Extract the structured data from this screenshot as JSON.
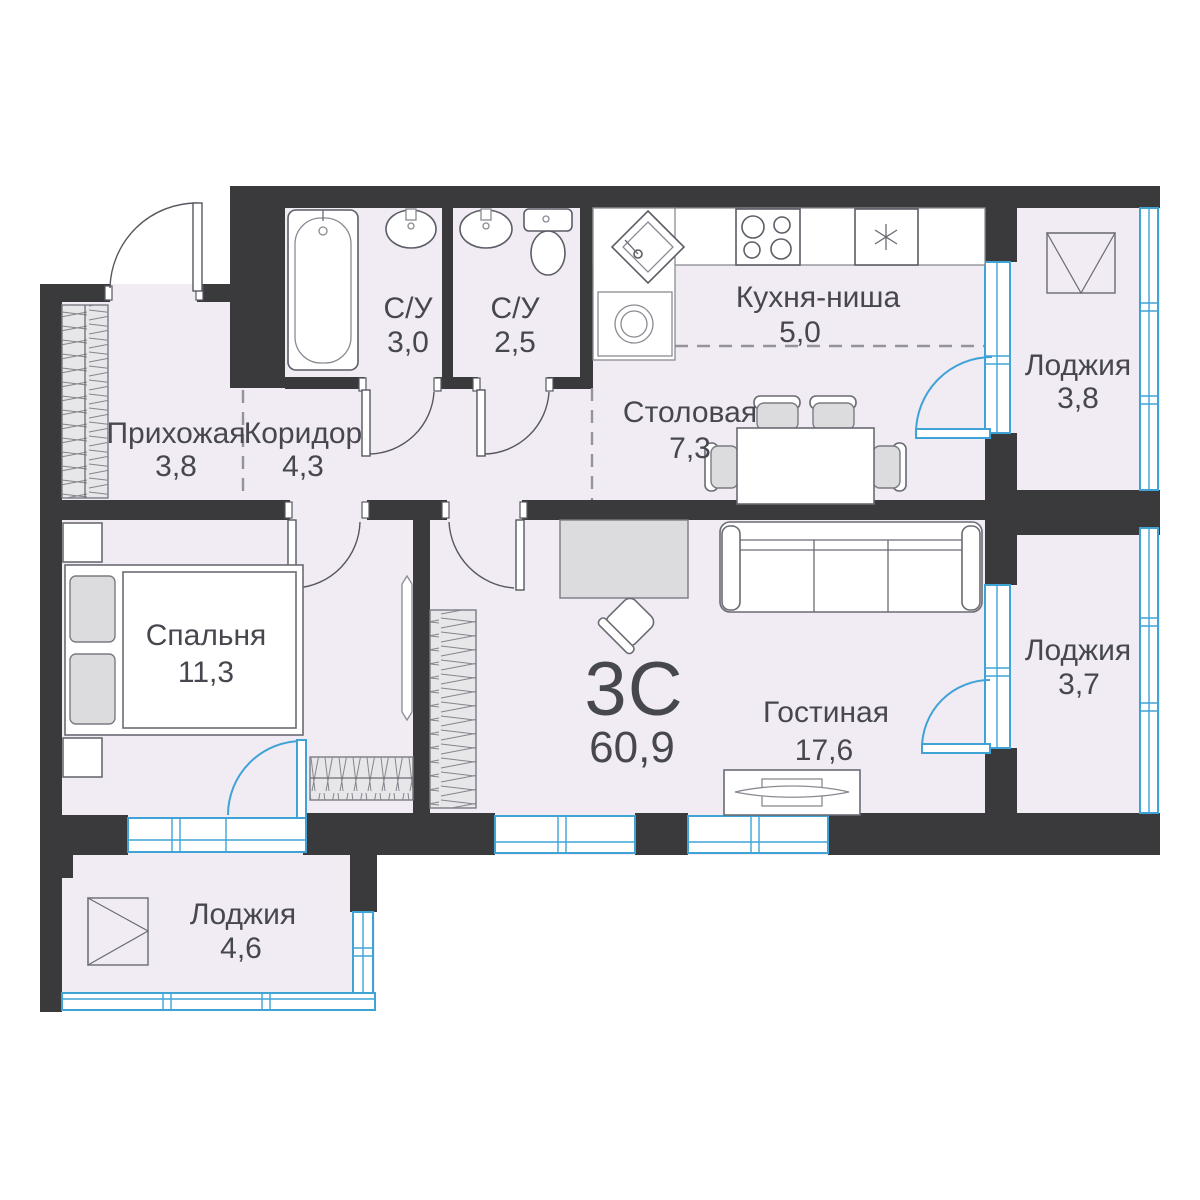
{
  "plan": {
    "title": {
      "type_label": "3С",
      "total_area": "60,9"
    },
    "rooms": {
      "hallway": {
        "name": "Прихожая",
        "area": "3,8"
      },
      "corridor": {
        "name": "Коридор",
        "area": "4,3"
      },
      "bathroom_1": {
        "name": "С/У",
        "area": "3,0"
      },
      "bathroom_2": {
        "name": "С/У",
        "area": "2,5"
      },
      "kitchen_niche": {
        "name": "Кухня-ниша",
        "area": "5,0"
      },
      "dining": {
        "name": "Столовая",
        "area": "7,3"
      },
      "bedroom": {
        "name": "Спальня",
        "area": "11,3"
      },
      "living": {
        "name": "Гостиная",
        "area": "17,6"
      },
      "loggia_top": {
        "name": "Лоджия",
        "area": "3,8"
      },
      "loggia_right": {
        "name": "Лоджия",
        "area": "3,7"
      },
      "loggia_bottom": {
        "name": "Лоджия",
        "area": "4,6"
      }
    },
    "colors": {
      "wall": "#3a3a3d",
      "floor": "#f1ebf4",
      "glazing_blue": "#3fa3d6",
      "text": "#47484f",
      "background": "#ffffff"
    }
  }
}
